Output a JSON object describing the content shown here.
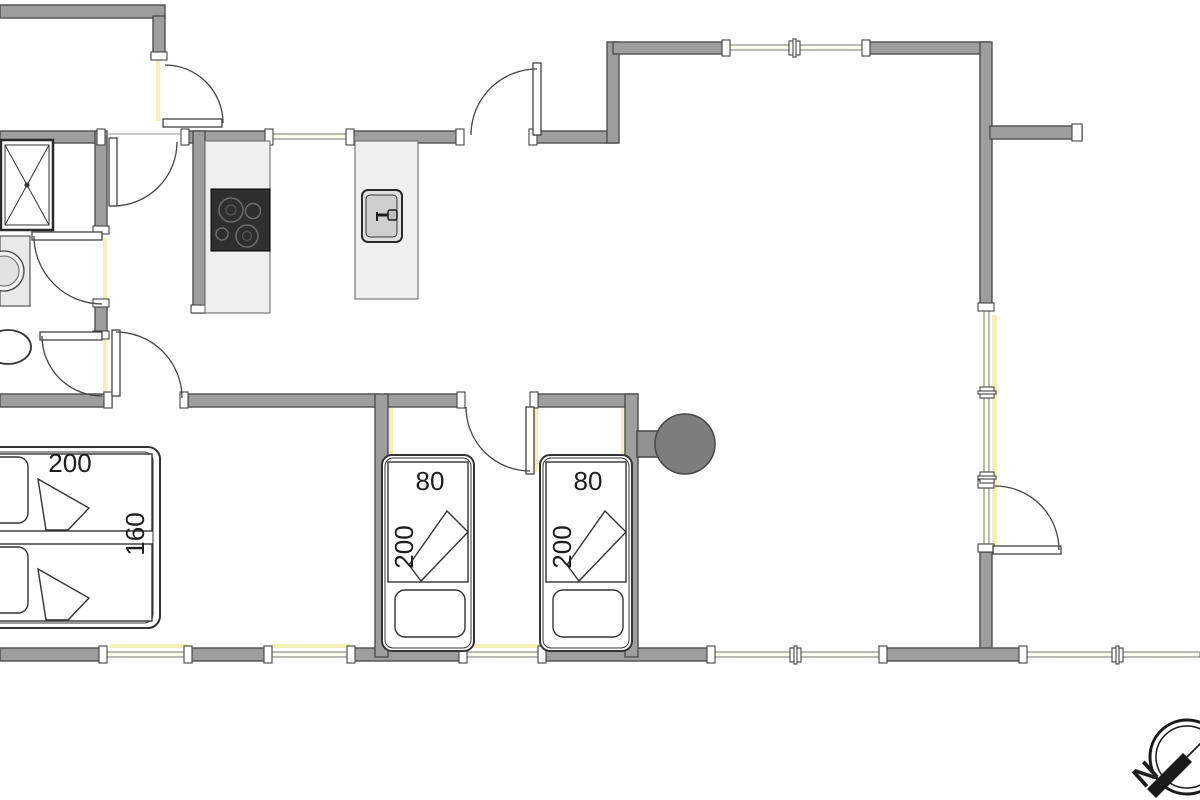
{
  "drawing": {
    "type": "floor-plan",
    "labels": {
      "double_bed_length": "200",
      "double_bed_width": "160",
      "single_bed_1_width": "80",
      "single_bed_1_length": "200",
      "single_bed_2_width": "80",
      "single_bed_2_length": "200",
      "compass_north": "N"
    },
    "fixtures": [
      "shower",
      "washbasin",
      "toilet",
      "kitchen-cooktop",
      "kitchen-counter",
      "kitchen-island",
      "island-sink",
      "wood-stove",
      "double-bed",
      "single-bed-1",
      "single-bed-2",
      "compass-rose"
    ],
    "colors": {
      "wall_fill": "#9e9e9e",
      "wall_outline": "#4f4f4f",
      "counter_fill": "#efefef",
      "cooktop_fill": "#2f2f2f",
      "stove_fill": "#7d7d7d",
      "threshold_accent": "#f2f2b8",
      "line": "#444444",
      "background": "#ffffff"
    }
  }
}
